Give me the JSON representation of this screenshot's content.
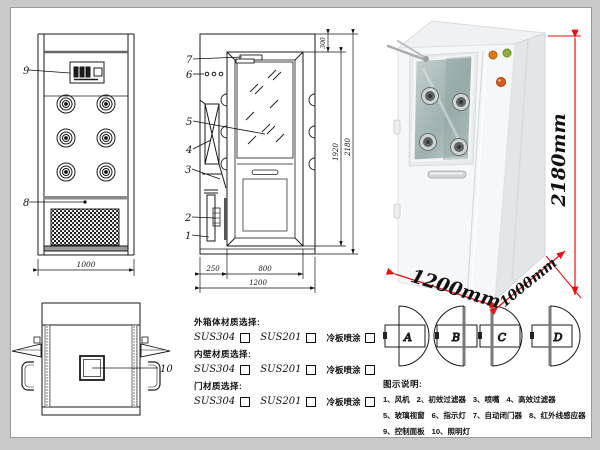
{
  "front_view": {
    "label_9": "9",
    "label_8": "8",
    "dim_width": "1000"
  },
  "side_view": {
    "label_7": "7",
    "label_6": "6",
    "label_5": "5",
    "label_4": "4",
    "label_3": "3",
    "label_2": "2",
    "label_1": "1",
    "dim_top": "300",
    "dim_door_height": "1920",
    "dim_total_height": "2180",
    "dim_side": "250",
    "dim_door_width": "800",
    "dim_total_width": "1200"
  },
  "photo": {
    "dim_height": "2180mm",
    "dim_width": "1200mm",
    "dim_depth": "1000mm",
    "dim_color": "#e81010"
  },
  "top_view": {
    "label_10": "10"
  },
  "materials": {
    "groups": [
      {
        "title": "外箱体材质选择:",
        "opt1": "SUS304",
        "opt2": "SUS201",
        "opt3": "冷板喷涂"
      },
      {
        "title": "内壁材质选择:",
        "opt1": "SUS304",
        "opt2": "SUS201",
        "opt3": "冷板喷涂"
      },
      {
        "title": "门材质选择:",
        "opt1": "SUS304",
        "opt2": "SUS201",
        "opt3": "冷板喷涂"
      }
    ]
  },
  "door_options": {
    "a": "A",
    "b": "B",
    "c": "C",
    "d": "D"
  },
  "legend": {
    "title": "图示说明:",
    "rows": [
      [
        "1、风机",
        "2、初效过滤器",
        "3、喷嘴",
        "4、高效过滤器"
      ],
      [
        "5、玻璃视窗",
        "6、指示灯",
        "7、自动闭门器",
        "8、红外线感应器"
      ],
      [
        "9、控制面板",
        "10、照明灯"
      ]
    ]
  }
}
